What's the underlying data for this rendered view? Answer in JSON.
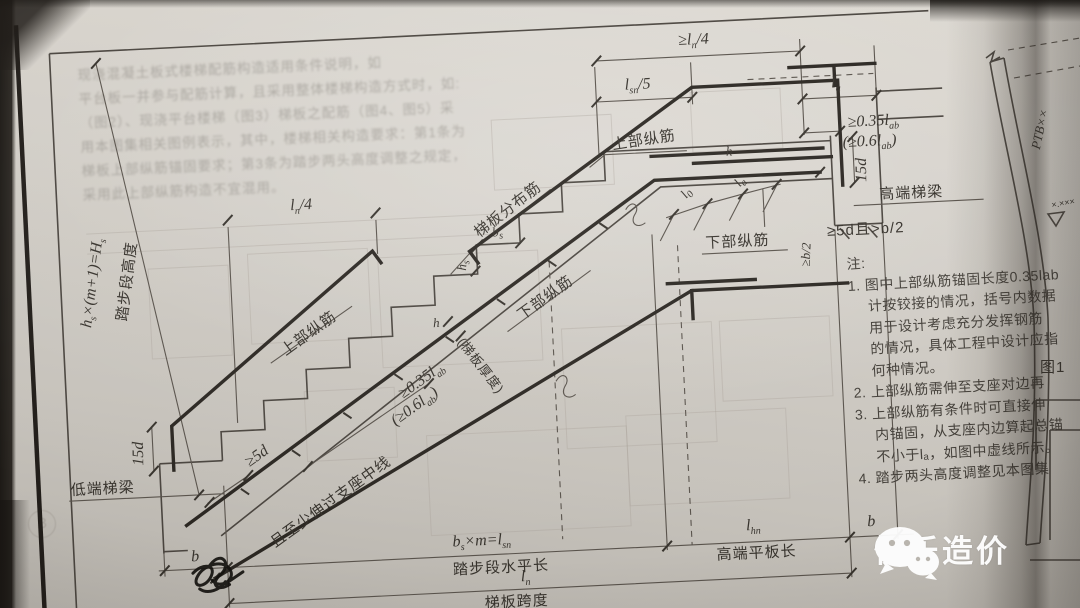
{
  "labels": {
    "ln4_top": {
      "pre": "≥l",
      "sub": "n",
      "post": "/4"
    },
    "lsn5": {
      "pre": "l",
      "sub": "sn",
      "post": "/5"
    },
    "la_top": {
      "pre": "l",
      "sub": "a"
    },
    "lab035_high": {
      "pre": "≥0.35l",
      "sub": "ab"
    },
    "lab06_high": {
      "pre": "(≥0.6l",
      "sub": "ab",
      "post": ")"
    },
    "d15": "15d",
    "beam_high": "高端梯梁",
    "anchor_5d_b2": "≥5d且>b/2",
    "anchor_b2": "≥b/2",
    "top_bars": "上部纵筋",
    "dist_bars": "梯板分布筋",
    "ln4_left": {
      "pre": "l",
      "sub": "n",
      "post": "/4"
    },
    "lab035_low": {
      "pre": "≥0.35l",
      "sub": "ab"
    },
    "lab06_low": {
      "pre": "(≥0.6l",
      "sub": "ab",
      "post": ")"
    },
    "anchor_5d": "≥5d",
    "anchor_mid": "且至少伸过支座中线",
    "bottom_bars": "下部纵筋",
    "l0": {
      "pre": "l",
      "sub": "0"
    },
    "la_small": {
      "pre": "l",
      "sub": "a"
    },
    "h": "h",
    "h_thickness": "(梯板厚度)",
    "bs": {
      "pre": "b",
      "sub": "s"
    },
    "hs": {
      "pre": "h",
      "sub": "s"
    },
    "hs_formula": {
      "pre": "h",
      "sub": "s",
      "mid": "×(m+1)=H",
      "sub2": "s"
    },
    "riser_height": "踏步段高度",
    "beam_low": "低端梯梁",
    "b": "b",
    "bsm_formula": {
      "pre": "b",
      "sub": "s",
      "mid": "×m=l",
      "sub2": "sn"
    },
    "run_length": "踏步段水平长",
    "lhn": {
      "pre": "l",
      "sub": "hn"
    },
    "platform_length": "高端平板长",
    "ln": {
      "pre": "l",
      "sub": "n"
    },
    "span": "梯板跨度"
  },
  "notes": {
    "lines": [
      "注:",
      "1. 图中上部纵筋锚固长度0.35lab",
      "计按铰接的情况，括号内数据",
      "用于设计考虑充分发挥钢筋",
      "的情况，具体工程中设计应指",
      "何种情况。",
      "2. 上部纵筋需伸至支座对边再",
      "3. 上部纵筋有条件时可直接伸",
      "内锚固，从支座内边算起总锚",
      "不小于lₐ，如图中虚线所示。",
      "4. 踏步两头高度调整见本图集"
    ]
  },
  "right_page": {
    "ptb": "PTB××",
    "level": "×.×××",
    "figure": "图1"
  },
  "bleed": {
    "lines": [
      "现浇混凝土板式楼梯配筋构造适用条件说明，如",
      "平台板一并参与配筋计算，且采用整体楼梯构造方式时，如:",
      "（图2）、现浇平台楼梯（图3）梯板之配筋（图4、图5）采",
      "用本图集相关图例表示，其中，楼梯相关构造要求：第1条为",
      "梯板上部纵筋锚固要求；第3条为踏步两头高度调整之规定，",
      "采用此上部纵筋构造不宜混用。"
    ],
    "circled": "B"
  },
  "watermark": {
    "text": "快乐造价"
  }
}
